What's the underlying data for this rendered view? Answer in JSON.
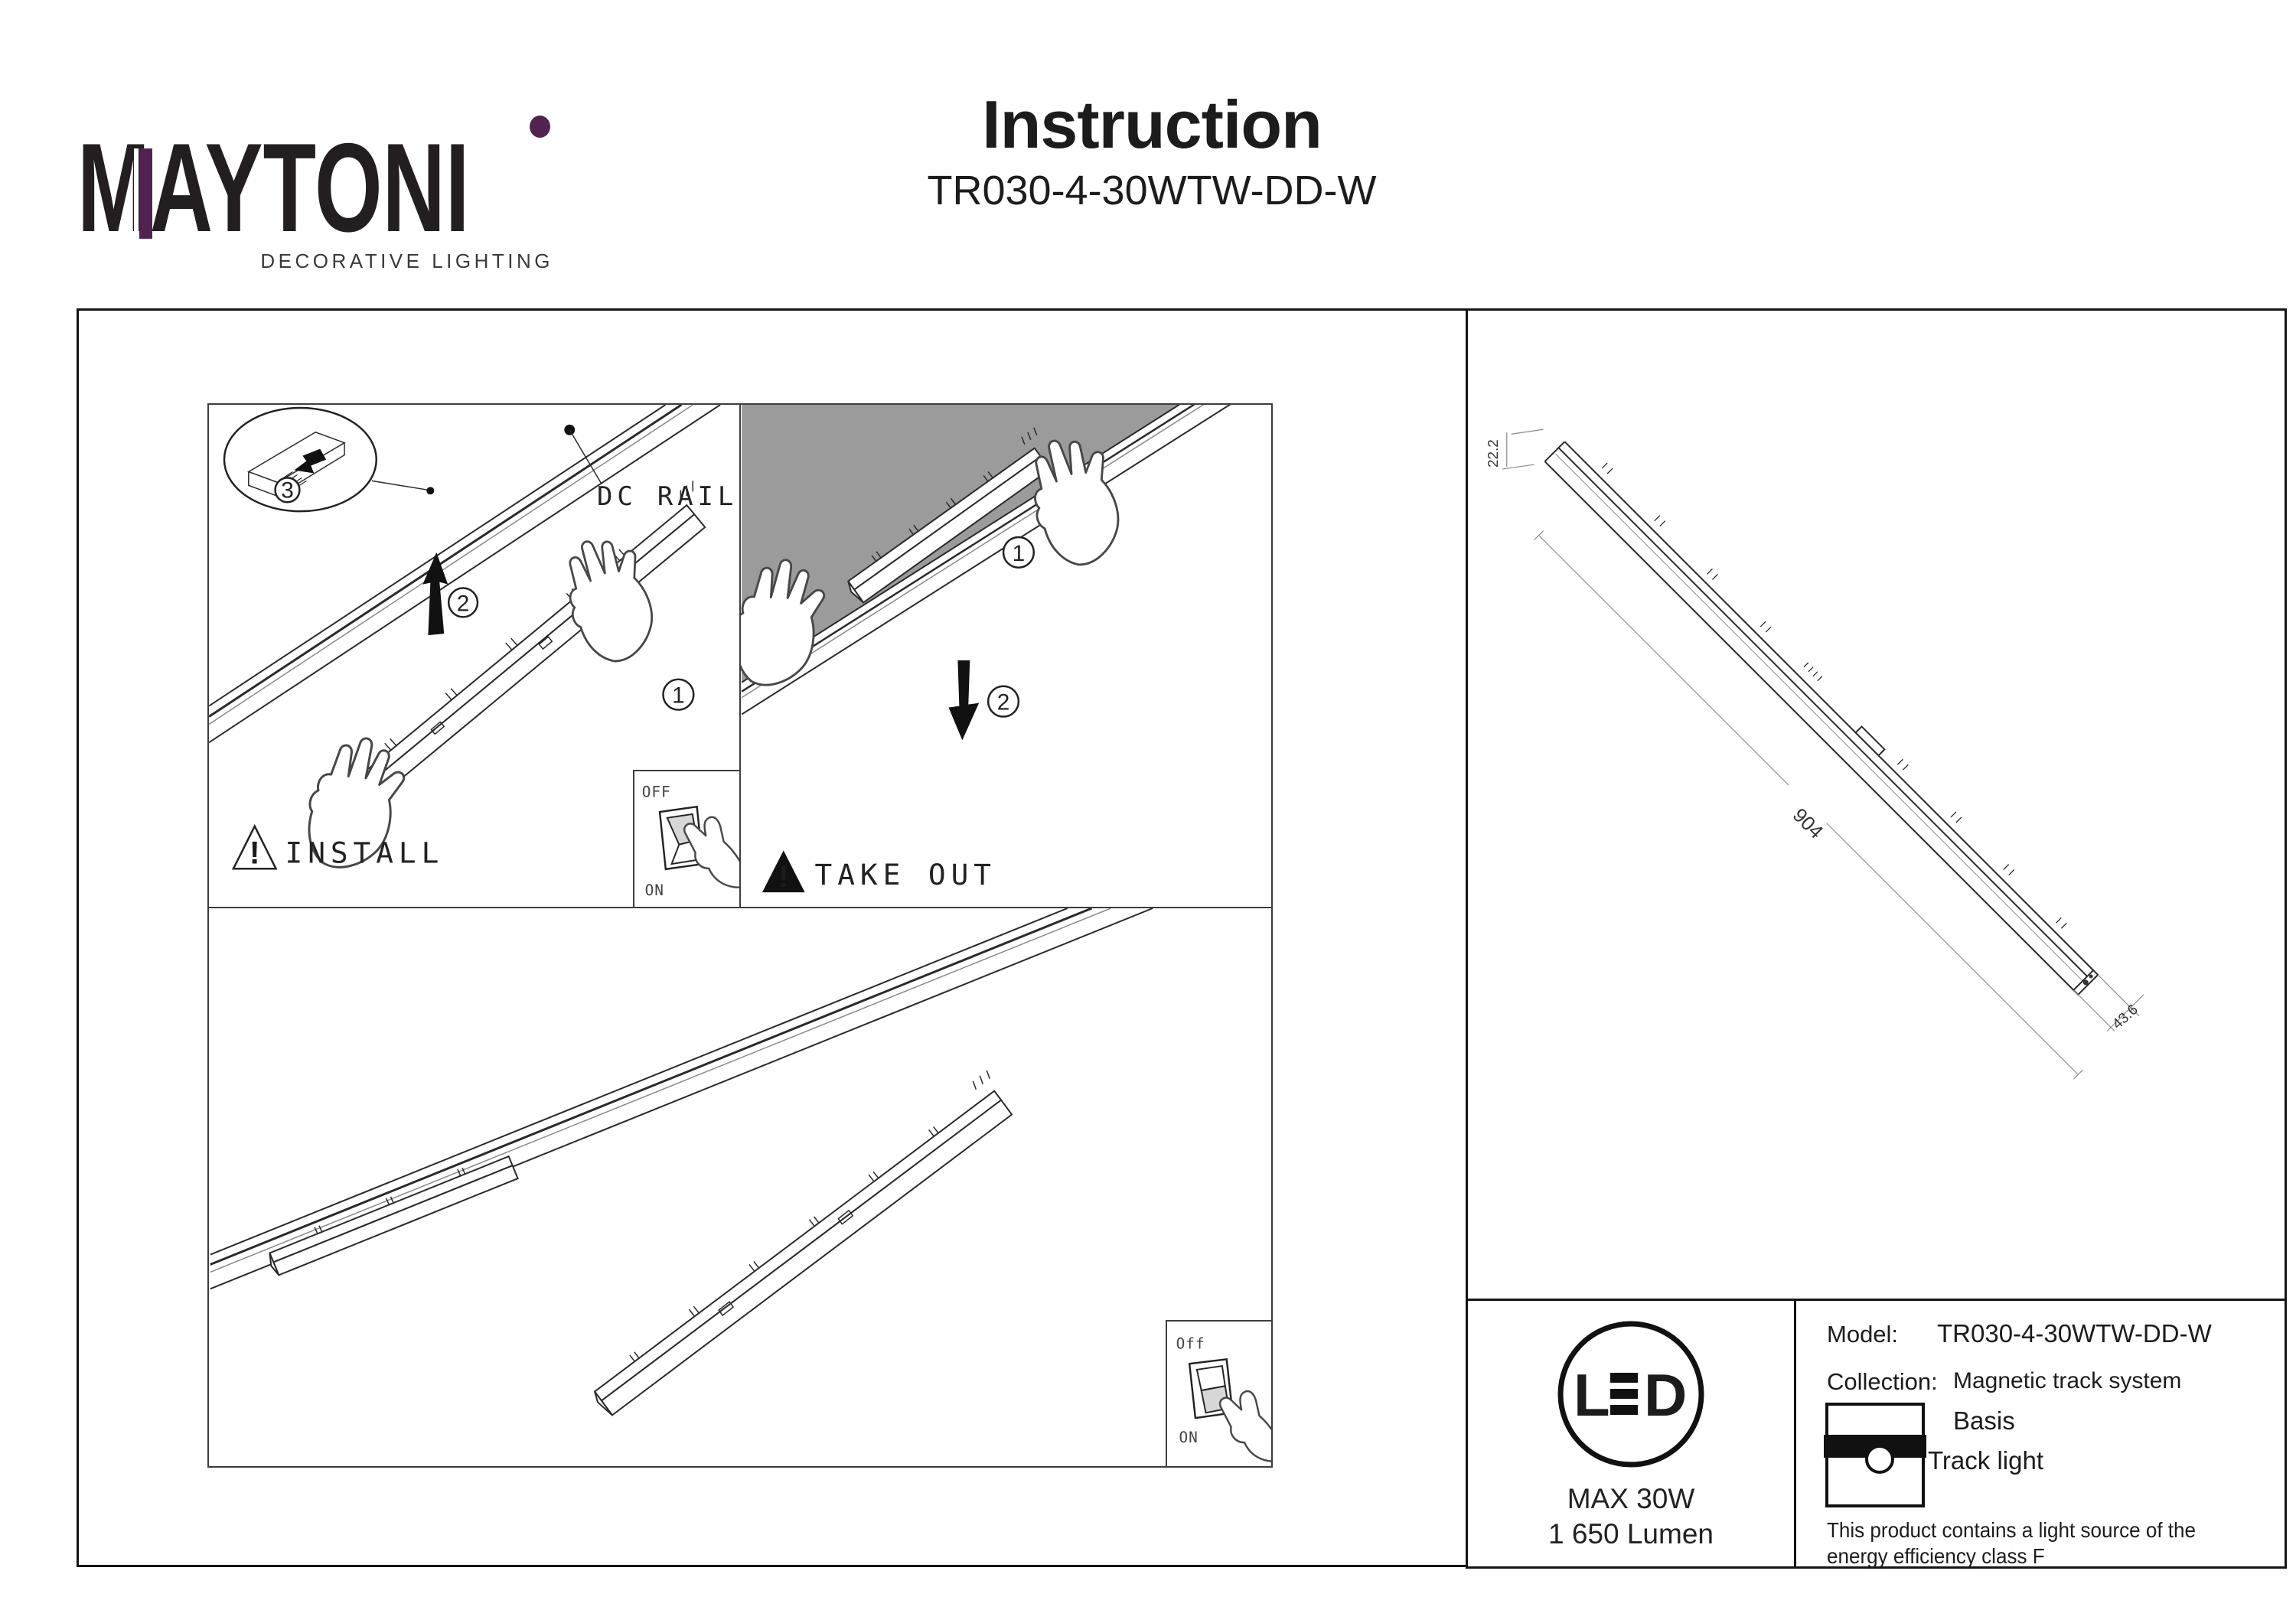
{
  "brand": {
    "word_m": "M",
    "word_mid": "AYTON",
    "word_i": "I",
    "tagline": "DECORATIVE LIGHTING",
    "purple": "#522250"
  },
  "header": {
    "title": "Instruction",
    "subtitle": "TR030-4-30WTW-DD-W"
  },
  "install": {
    "label": "INSTALL",
    "warning": "!",
    "dc_rail": "DC RAIL",
    "step1": "1",
    "step2": "2",
    "step3": "3",
    "switch_top": "OFF",
    "switch_bottom": "ON"
  },
  "take_out": {
    "label": "TAKE OUT",
    "warning": "!",
    "step1": "1",
    "step2": "2"
  },
  "mounted": {
    "switch_top": "Off",
    "switch_bottom": "ON"
  },
  "product": {
    "dim_length": "904",
    "dim_height": "22.2",
    "dim_depth": "43.6"
  },
  "led": {
    "letter_l": "L",
    "letter_d": "D",
    "max_power": "MAX 30W",
    "lumen": "1 650 Lumen"
  },
  "spec": {
    "model_label": "Model:",
    "model_value": "TR030-4-30WTW-DD-W",
    "collection_label": "Collection:",
    "collection_value": "Magnetic track system",
    "category1": "Basis",
    "category2": "Track light",
    "note1": "This product contains a light source of the",
    "note2": "energy efficiency class F"
  }
}
